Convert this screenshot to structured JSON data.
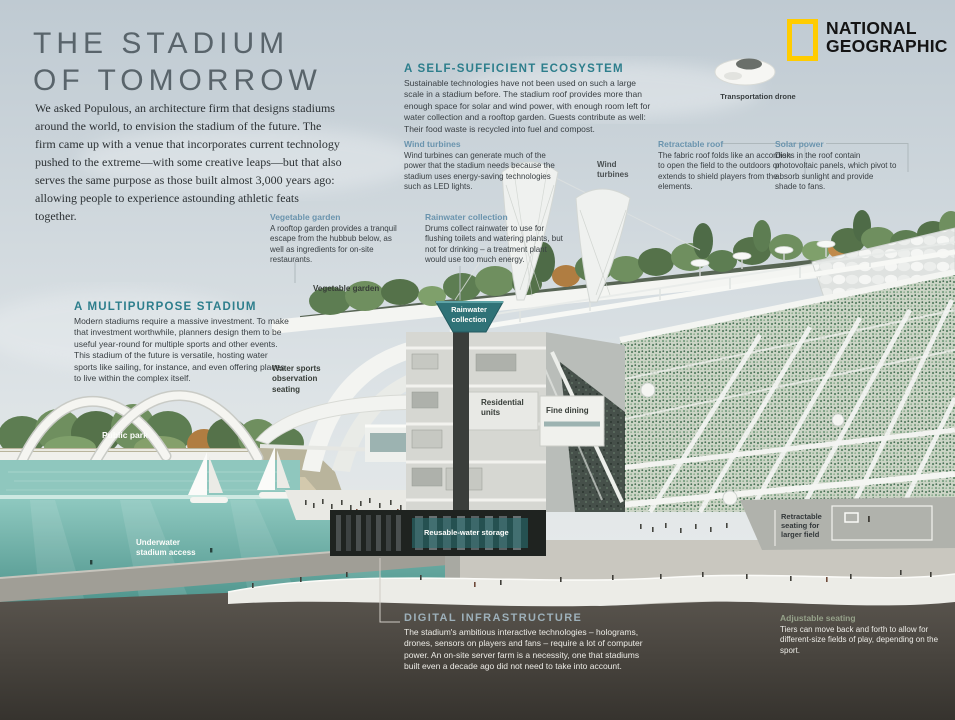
{
  "header": {
    "title": "THE STADIUM\nOF TOMORROW",
    "intro": "We asked Populous, an architecture firm that designs stadiums around the world, to envision the stadium of the future. The firm came up with a venue that incorporates current technology pushed to the extreme—with some creative leaps—but that also serves the same purpose as those built almost 3,000 years ago: allowing people to experience astounding athletic feats together."
  },
  "brand": {
    "name": "NATIONAL\nGEOGRAPHIC",
    "logo_color": "#FFCC00"
  },
  "sections": {
    "ecosystem": {
      "heading": "A SELF-SUFFICIENT ECOSYSTEM",
      "body": "Sustainable technologies have not been used on such a large scale in a stadium before. The stadium roof provides more than enough space for solar and wind power, with enough room left for water collection and a rooftop garden. Guests contribute as well: Their food waste is recycled into fuel and compost."
    },
    "multipurpose": {
      "heading": "A MULTIPURPOSE STADIUM",
      "body": "Modern stadiums require a massive investment. To make that investment worthwhile, planners design them to be useful year-round for multiple sports and other events. This stadium of the future is versatile, hosting water sports like sailing, for instance, and even offering places to live within the complex itself."
    },
    "digital": {
      "heading": "DIGITAL INFRASTRUCTURE",
      "body": "The stadium's ambitious interactive technologies – holograms, drones, sensors on players and fans – require a lot of computer power. An on-site server farm is a necessity, one that stadiums built even a decade ago did not need to take into account."
    }
  },
  "annotations": {
    "wind_turbines": {
      "heading": "Wind turbines",
      "body": "Wind turbines can generate much of the power that the stadium needs because the stadium uses energy-saving technologies such as LED lights."
    },
    "retractable_roof": {
      "heading": "Retractable roof",
      "body": "The fabric roof folds like an accordion to open the field to the outdoors or extends to shield players from the elements."
    },
    "solar_power": {
      "heading": "Solar power",
      "body": "Disks in the roof contain photovoltaic panels, which pivot to absorb sunlight and provide shade to fans."
    },
    "vegetable_garden": {
      "heading": "Vegetable garden",
      "body": "A rooftop garden provides a tranquil escape from the hubbub below, as well as ingredients for on-site restaurants."
    },
    "rainwater_collection": {
      "heading": "Rainwater collection",
      "body": "Drums collect rainwater to use for flushing toilets and watering plants, but not for drinking – a treatment plant would use too much energy."
    },
    "adjustable_seating": {
      "heading": "Adjustable seating",
      "body": "Tiers can move back and forth to allow for different-size fields of play, depending on the sport."
    }
  },
  "labels": {
    "transportation_drone": "Transportation drone",
    "vegetable_garden": "Vegetable garden",
    "wind_turbines": "Wind\nturbines",
    "water_sports": "Water sports\nobservation\nseating",
    "public_park": "Public park",
    "underwater_access": "Underwater\nstadium access",
    "residential_units": "Residential\nunits",
    "fine_dining": "Fine dining",
    "rainwater_badge": "Rainwater\ncollection",
    "reusable_water": "Reusable-water storage",
    "retractable_seating": "Retractable\nseating for\nlarger field"
  },
  "colors": {
    "accent_teal": "#2d7e8c",
    "accent_steel_blue": "#6a94ae",
    "brand_yellow": "#FFCC00",
    "digital_heading": "#9db0ba",
    "adjustable_heading": "#96a28a",
    "water_teal": "#7dbfb6",
    "dark_ground": "#433f39"
  }
}
